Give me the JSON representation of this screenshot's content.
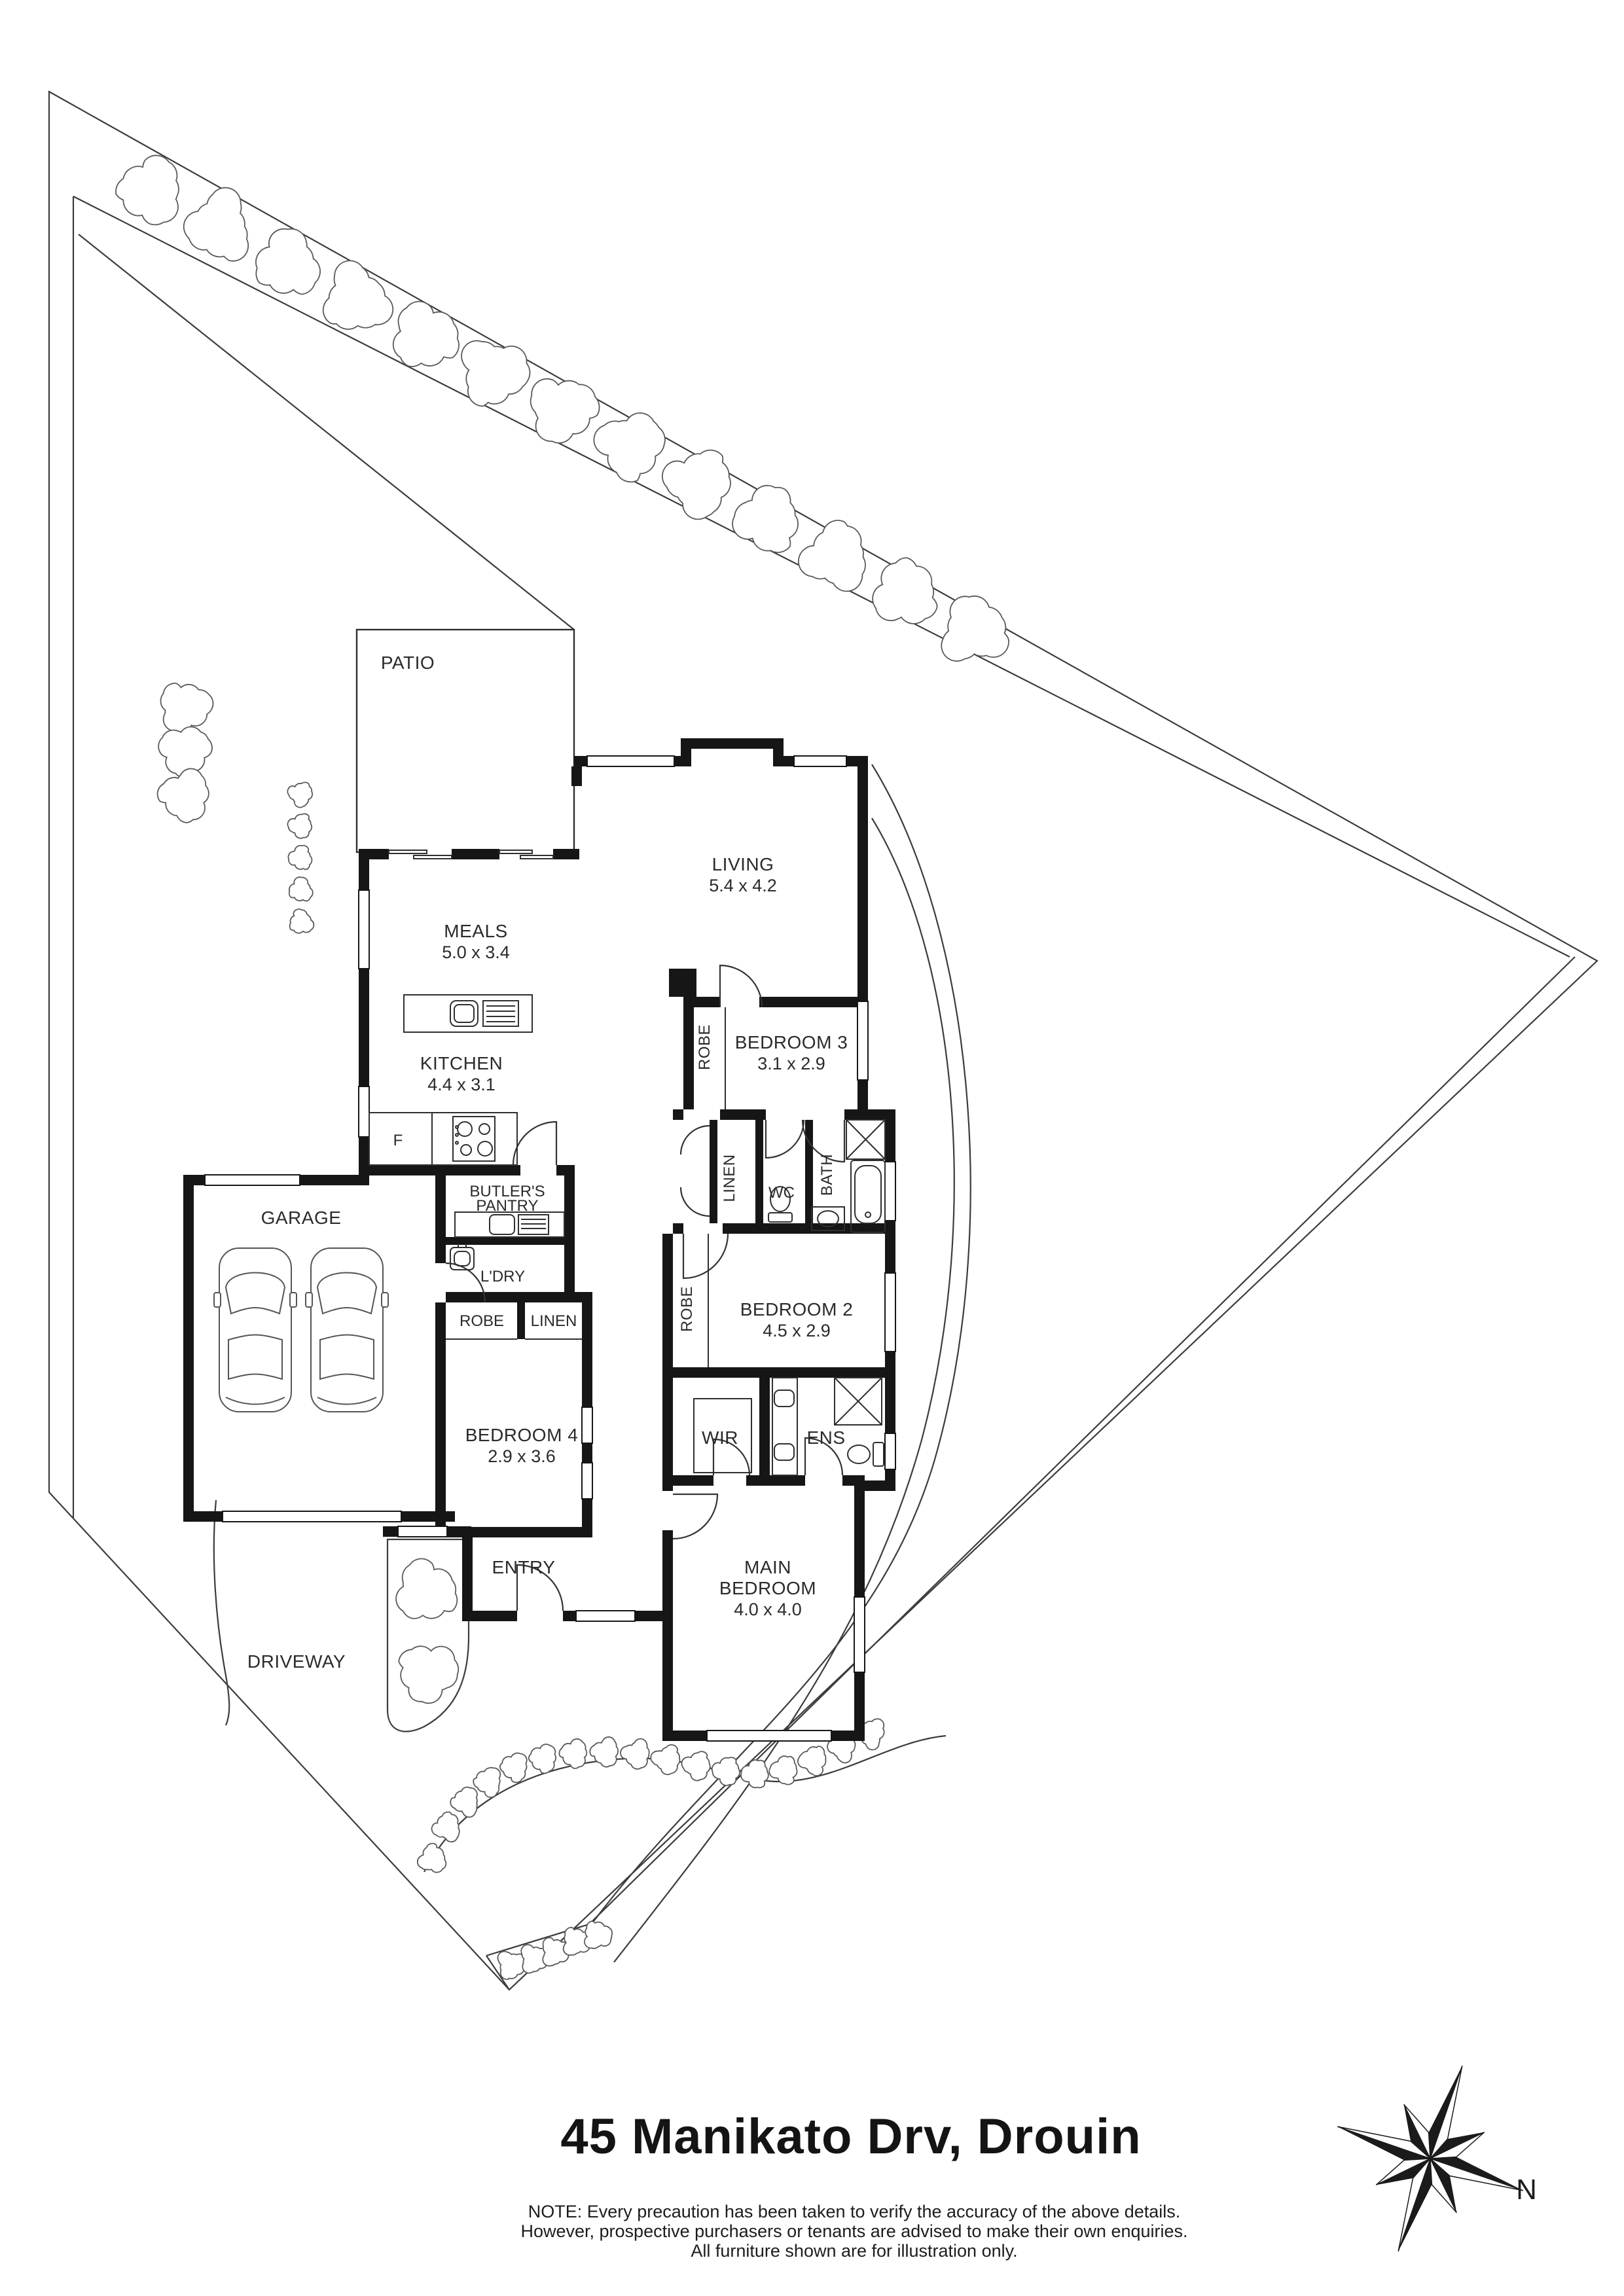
{
  "title": "45 Manikato Drv, Drouin",
  "note": {
    "line1": "NOTE: Every precaution has been taken to verify the accuracy of the above details.",
    "line2": "However, prospective purchasers or tenants are advised to make their own enquiries.",
    "line3": "All furniture shown are for illustration only."
  },
  "compass": {
    "north_label": "N"
  },
  "site": {
    "patio": "PATIO",
    "driveway": "DRIVEWAY",
    "entry": "ENTRY"
  },
  "rooms": {
    "living": {
      "name": "LIVING",
      "dim": "5.4 x 4.2"
    },
    "meals": {
      "name": "MEALS",
      "dim": "5.0 x 3.4"
    },
    "kitchen": {
      "name": "KITCHEN",
      "dim": "4.4 x 3.1"
    },
    "bedroom3": {
      "name": "BEDROOM 3",
      "dim": "3.1 x 2.9"
    },
    "bedroom2": {
      "name": "BEDROOM 2",
      "dim": "4.5 x 2.9"
    },
    "bedroom4": {
      "name": "BEDROOM 4",
      "dim": "2.9 x 3.6"
    },
    "main_bedroom": {
      "name1": "MAIN",
      "name2": "BEDROOM",
      "dim": "4.0 x 4.0"
    },
    "garage": {
      "name": "GARAGE"
    },
    "butlers_pantry": {
      "name1": "BUTLER'S",
      "name2": "PANTRY"
    },
    "laundry": {
      "name": "L'DRY"
    },
    "wc": {
      "name": "WC"
    },
    "bath": {
      "name": "BATH"
    },
    "ens": {
      "name": "ENS"
    },
    "wir": {
      "name": "WIR"
    },
    "linen_hall": {
      "name": "LINEN"
    },
    "linen_bed4": {
      "name": "LINEN"
    },
    "robe_bed3": {
      "name": "ROBE"
    },
    "robe_bed2": {
      "name": "ROBE"
    },
    "robe_bed4": {
      "name": "ROBE"
    },
    "fridge": {
      "name": "F"
    }
  }
}
